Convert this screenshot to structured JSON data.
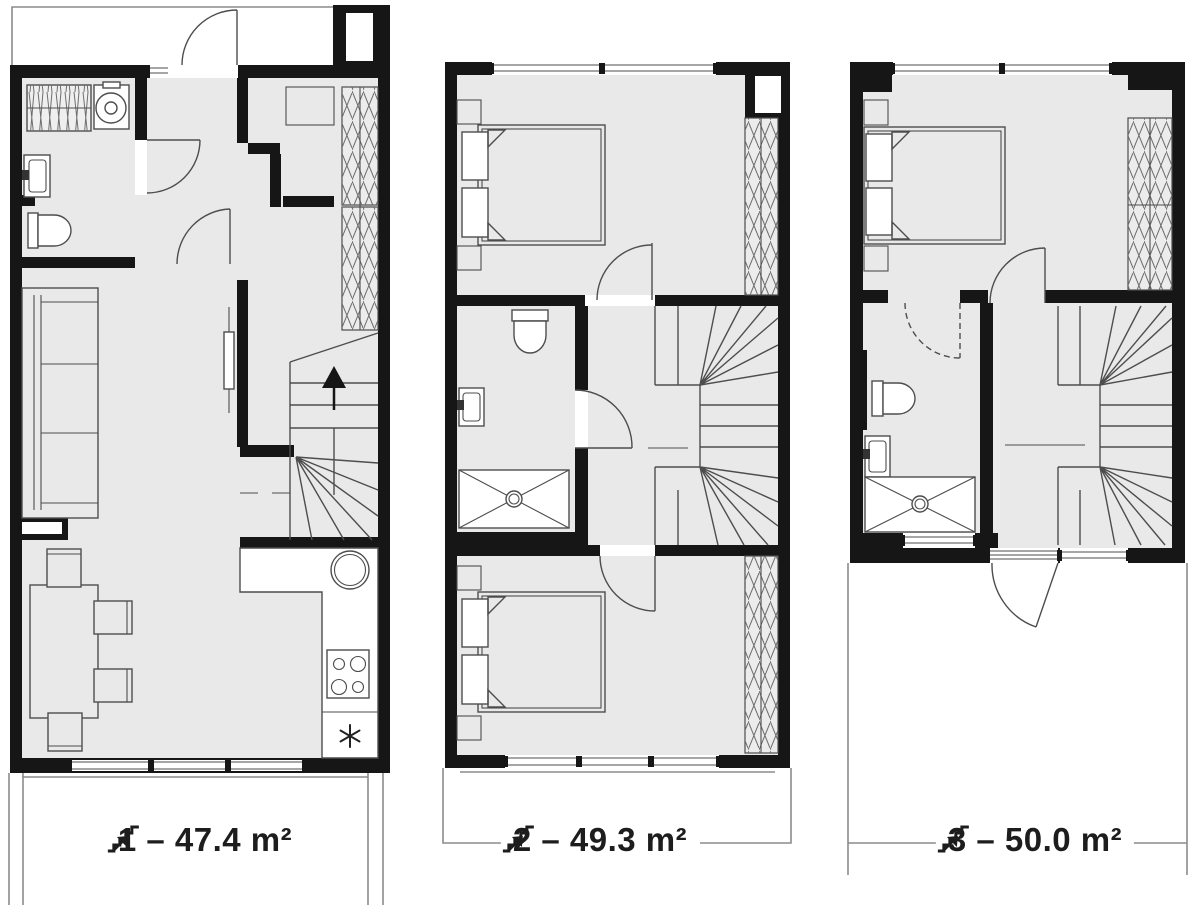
{
  "document": {
    "type": "architectural floor plan sheet",
    "floors_shown": 3
  },
  "colors": {
    "background": "#ffffff",
    "wall": "#161616",
    "floor_fill": "#e9e9e9",
    "furniture_line": "#4d4d4d",
    "outline_light": "#8c8c8c",
    "label_text": "#1d1d1d"
  },
  "plans": [
    {
      "floor": "1",
      "area_value": "47.4",
      "unit": "m²",
      "area_label": "1 – 47.4 m²",
      "icon": "stairs-up-icon"
    },
    {
      "floor": "2",
      "area_value": "49.3",
      "unit": "m²",
      "area_label": "2 – 49.3 m²",
      "icon": "stairs-up-icon"
    },
    {
      "floor": "3",
      "area_value": "50.0",
      "unit": "m²",
      "area_label": "3 – 50.0 m²",
      "icon": "stairs-up-icon"
    }
  ]
}
